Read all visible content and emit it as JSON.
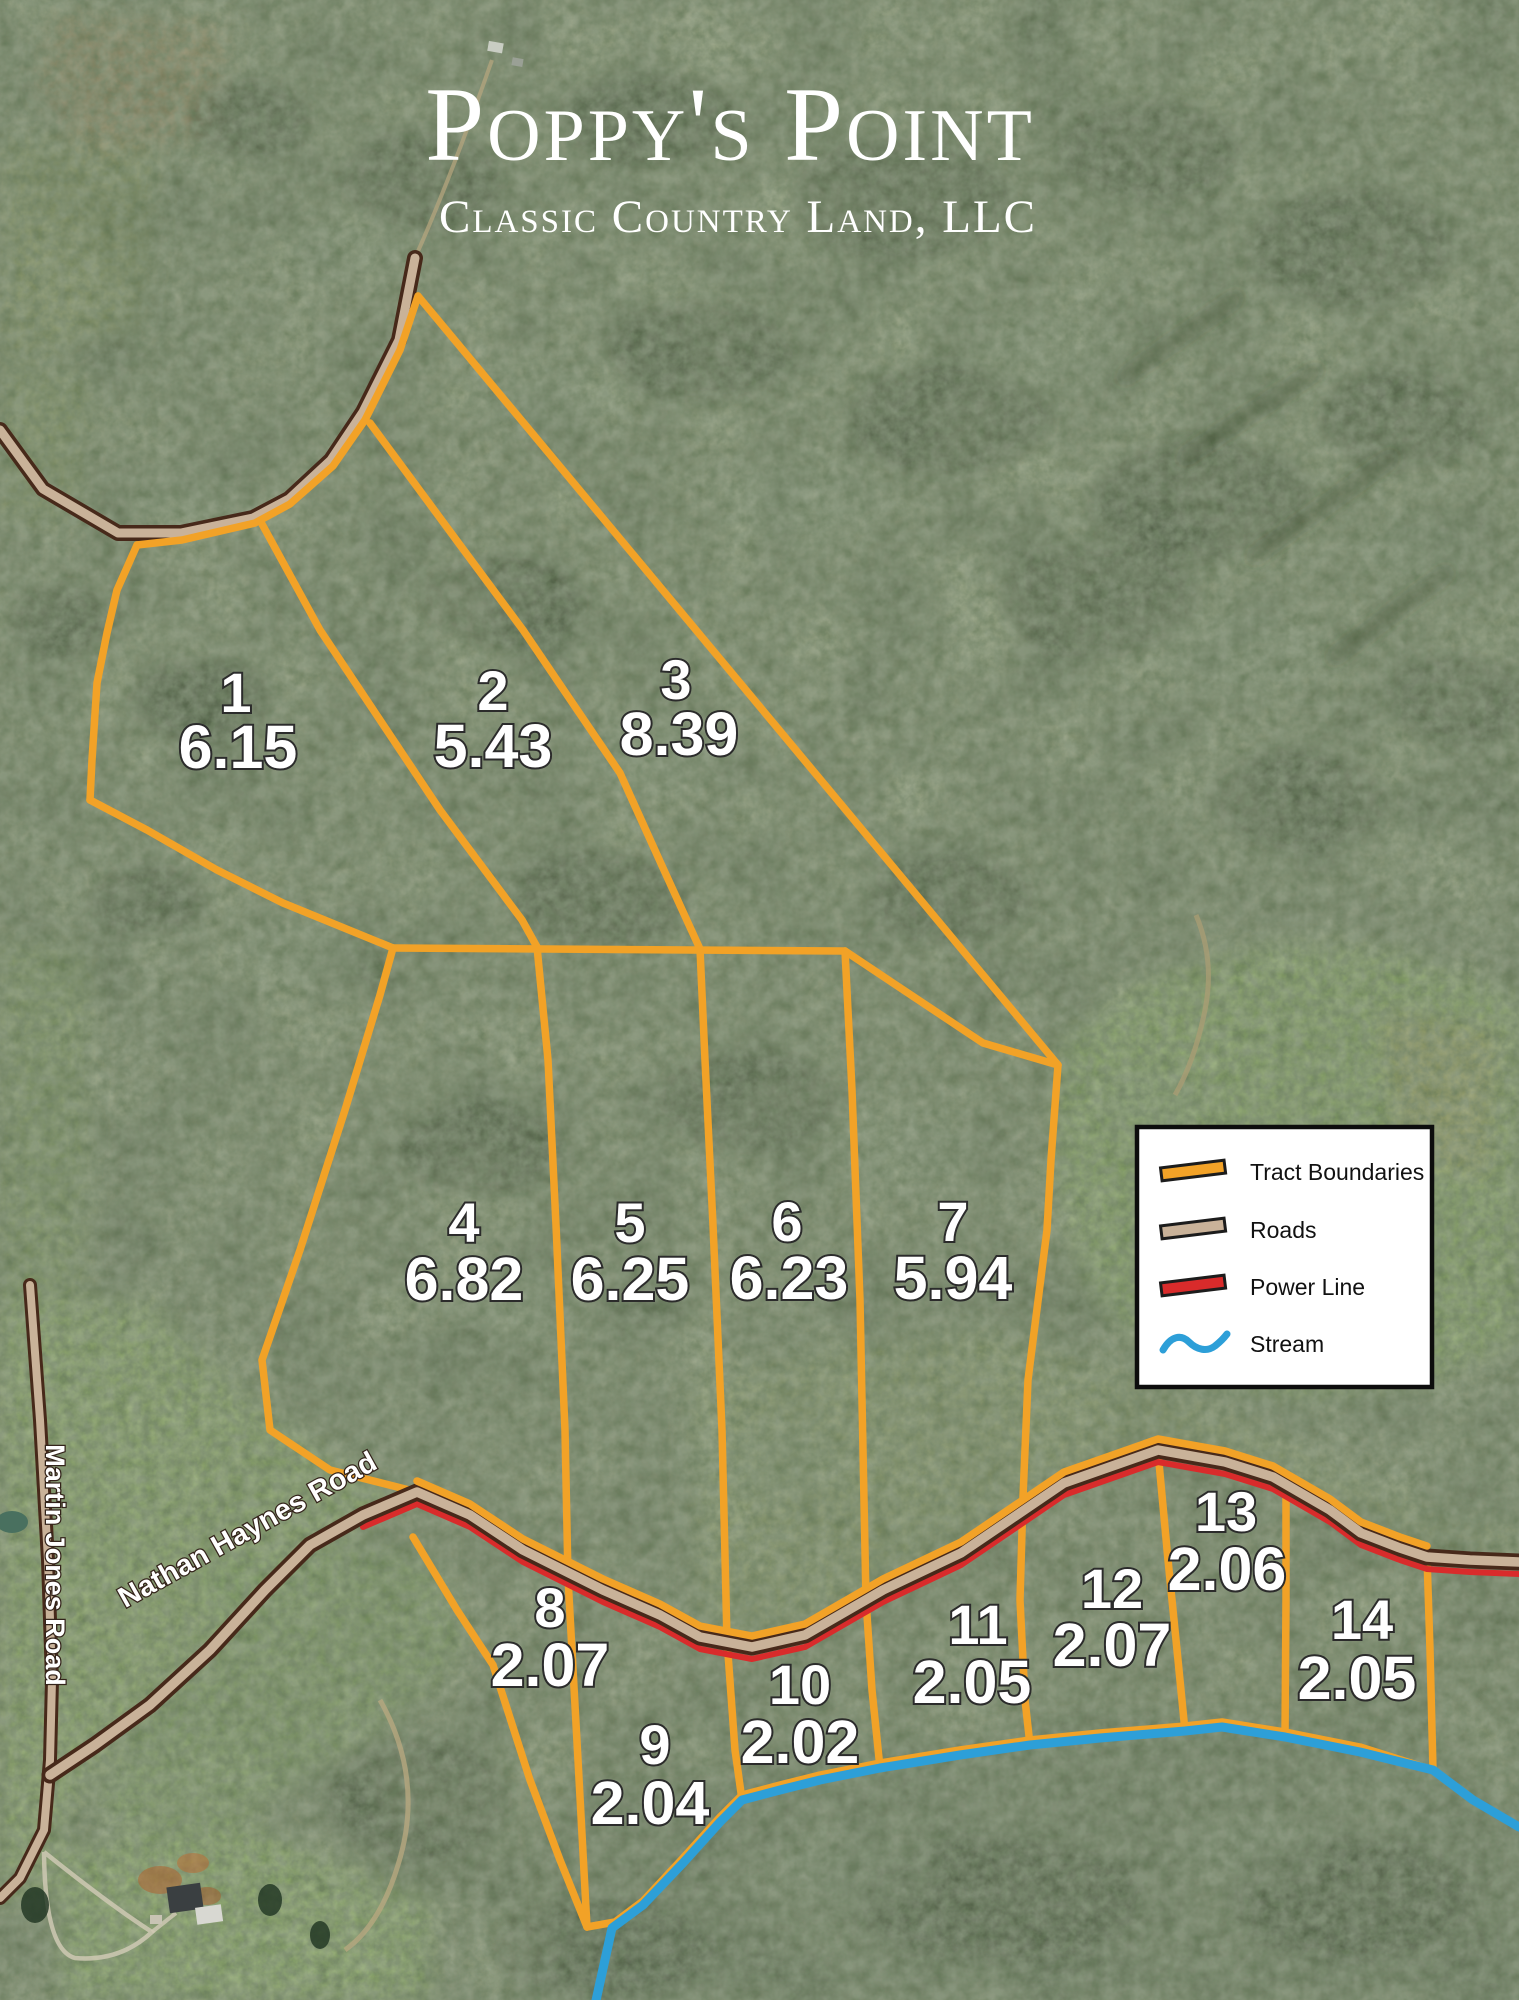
{
  "title": {
    "text": "Poppy's Point",
    "subtitle": "Classic Country Land, LLC"
  },
  "legend": {
    "items": [
      {
        "name": "tract-boundaries",
        "label": "Tract Boundaries",
        "color": "#F2A227"
      },
      {
        "name": "roads",
        "label": "Roads",
        "color": "#C9B299"
      },
      {
        "name": "power-line",
        "label": "Power Line",
        "color": "#D92B2B"
      },
      {
        "name": "stream",
        "label": "Stream",
        "color": "#2D9FD8"
      }
    ]
  },
  "roads": {
    "martin_jones": "Martin Jones Road",
    "nathan_haynes": "Nathan Haynes Road"
  },
  "tracts": [
    {
      "number": "1",
      "acreage": "6.15",
      "nx": 236,
      "ny": 692,
      "ax": 238,
      "ay": 746
    },
    {
      "number": "2",
      "acreage": "5.43",
      "nx": 493,
      "ny": 690,
      "ax": 493,
      "ay": 745
    },
    {
      "number": "3",
      "acreage": "8.39",
      "nx": 676,
      "ny": 679,
      "ax": 679,
      "ay": 733
    },
    {
      "number": "4",
      "acreage": "6.82",
      "nx": 464,
      "ny": 1222,
      "ax": 464,
      "ay": 1278
    },
    {
      "number": "5",
      "acreage": "6.25",
      "nx": 630,
      "ny": 1222,
      "ax": 630,
      "ay": 1278
    },
    {
      "number": "6",
      "acreage": "6.23",
      "nx": 787,
      "ny": 1221,
      "ax": 789,
      "ay": 1277
    },
    {
      "number": "7",
      "acreage": "5.94",
      "nx": 953,
      "ny": 1221,
      "ax": 953,
      "ay": 1277
    },
    {
      "number": "8",
      "acreage": "2.07",
      "nx": 550,
      "ny": 1607,
      "ax": 550,
      "ay": 1664
    },
    {
      "number": "9",
      "acreage": "2.04",
      "nx": 655,
      "ny": 1744,
      "ax": 650,
      "ay": 1802
    },
    {
      "number": "10",
      "acreage": "2.02",
      "nx": 800,
      "ny": 1684,
      "ax": 800,
      "ay": 1741
    },
    {
      "number": "11",
      "acreage": "2.05",
      "nx": 978,
      "ny": 1624,
      "ax": 972,
      "ay": 1681
    },
    {
      "number": "12",
      "acreage": "2.07",
      "nx": 1112,
      "ny": 1588,
      "ax": 1112,
      "ay": 1644
    },
    {
      "number": "13",
      "acreage": "2.06",
      "nx": 1226,
      "ny": 1511,
      "ax": 1227,
      "ay": 1568
    },
    {
      "number": "14",
      "acreage": "2.05",
      "nx": 1362,
      "ny": 1619,
      "ax": 1357,
      "ay": 1677
    }
  ],
  "colors": {
    "tract_boundary": "#F2A227",
    "road_fill": "#C9B299",
    "road_outline": "#47291A",
    "power_line": "#D92B2B",
    "stream": "#2D9FD8",
    "label_text": "#FFFFFF"
  }
}
